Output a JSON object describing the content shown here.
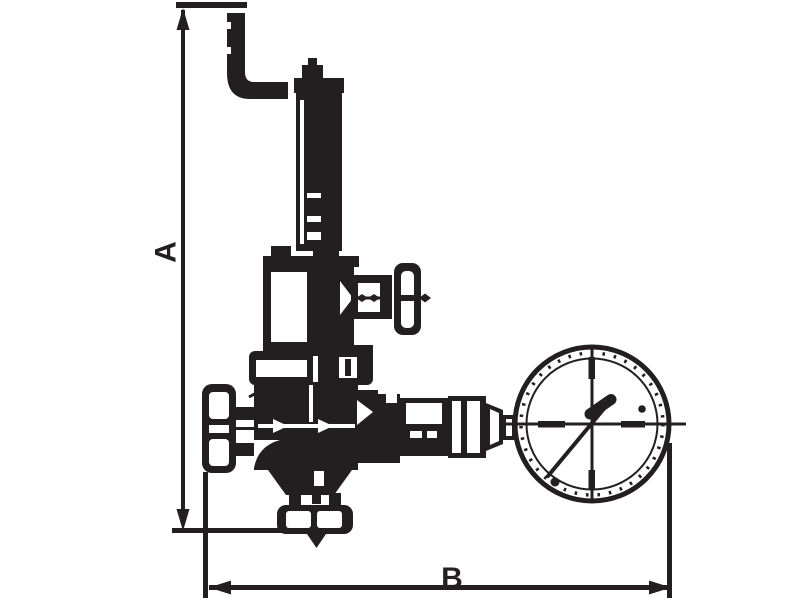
{
  "figure": {
    "kind": "technical-line-drawing",
    "subject": "pressure-reducing-valve-with-pressure-gauge",
    "ink_color": "#231f20",
    "background_color": "#ffffff"
  },
  "dimension_labels": {
    "vertical": "A",
    "horizontal": "B"
  }
}
